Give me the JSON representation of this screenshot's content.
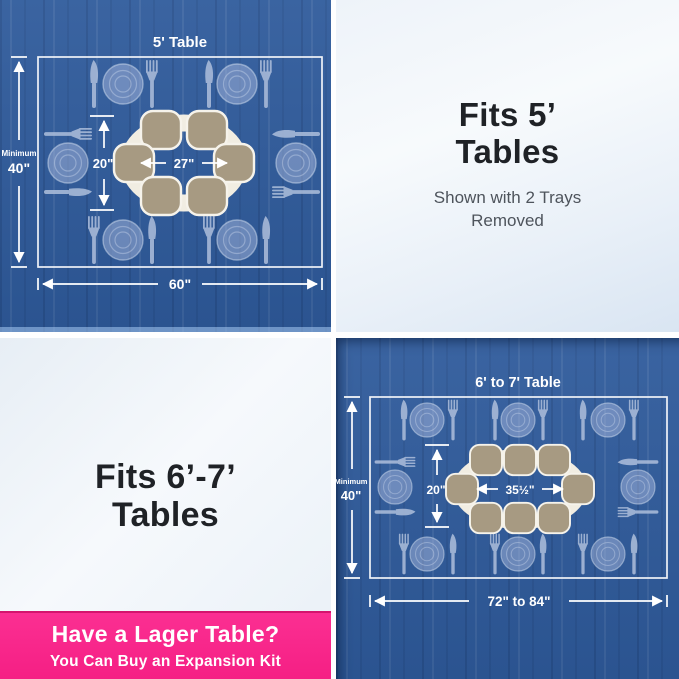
{
  "five_ft_diagram": {
    "title": "5' Table",
    "min_label": "Minimum",
    "table_depth": "40\"",
    "susan_depth": "20\"",
    "susan_width": "27\"",
    "table_width": "60\""
  },
  "fits_5ft_panel": {
    "heading_line1": "Fits 5’",
    "heading_line2": "Tables",
    "note_line1": "Shown with 2 Trays",
    "note_line2": "Removed"
  },
  "fits_67ft_panel": {
    "heading_line1": "Fits 6’-7’",
    "heading_line2": "Tables"
  },
  "six_seven_ft_diagram": {
    "title": "6' to 7' Table",
    "min_label": "Minimum",
    "table_depth": "40\"",
    "susan_depth": "20\"",
    "susan_width": "35½\"",
    "table_width": "72\" to 84\""
  },
  "banner": {
    "heading": "Have a Lager Table?",
    "subtext": "You Can Buy an Expansion Kit"
  },
  "colors": {
    "wood_blue": "#2e5a9b",
    "banner_pink": "#f9278c",
    "tray_tan": "#a79a82",
    "susan_cream": "#f1ede2",
    "plate_blue": "#aebedd",
    "dimension_white": "#ffffff",
    "heading_dark": "#1f2226",
    "note_gray": "#4e545c"
  }
}
